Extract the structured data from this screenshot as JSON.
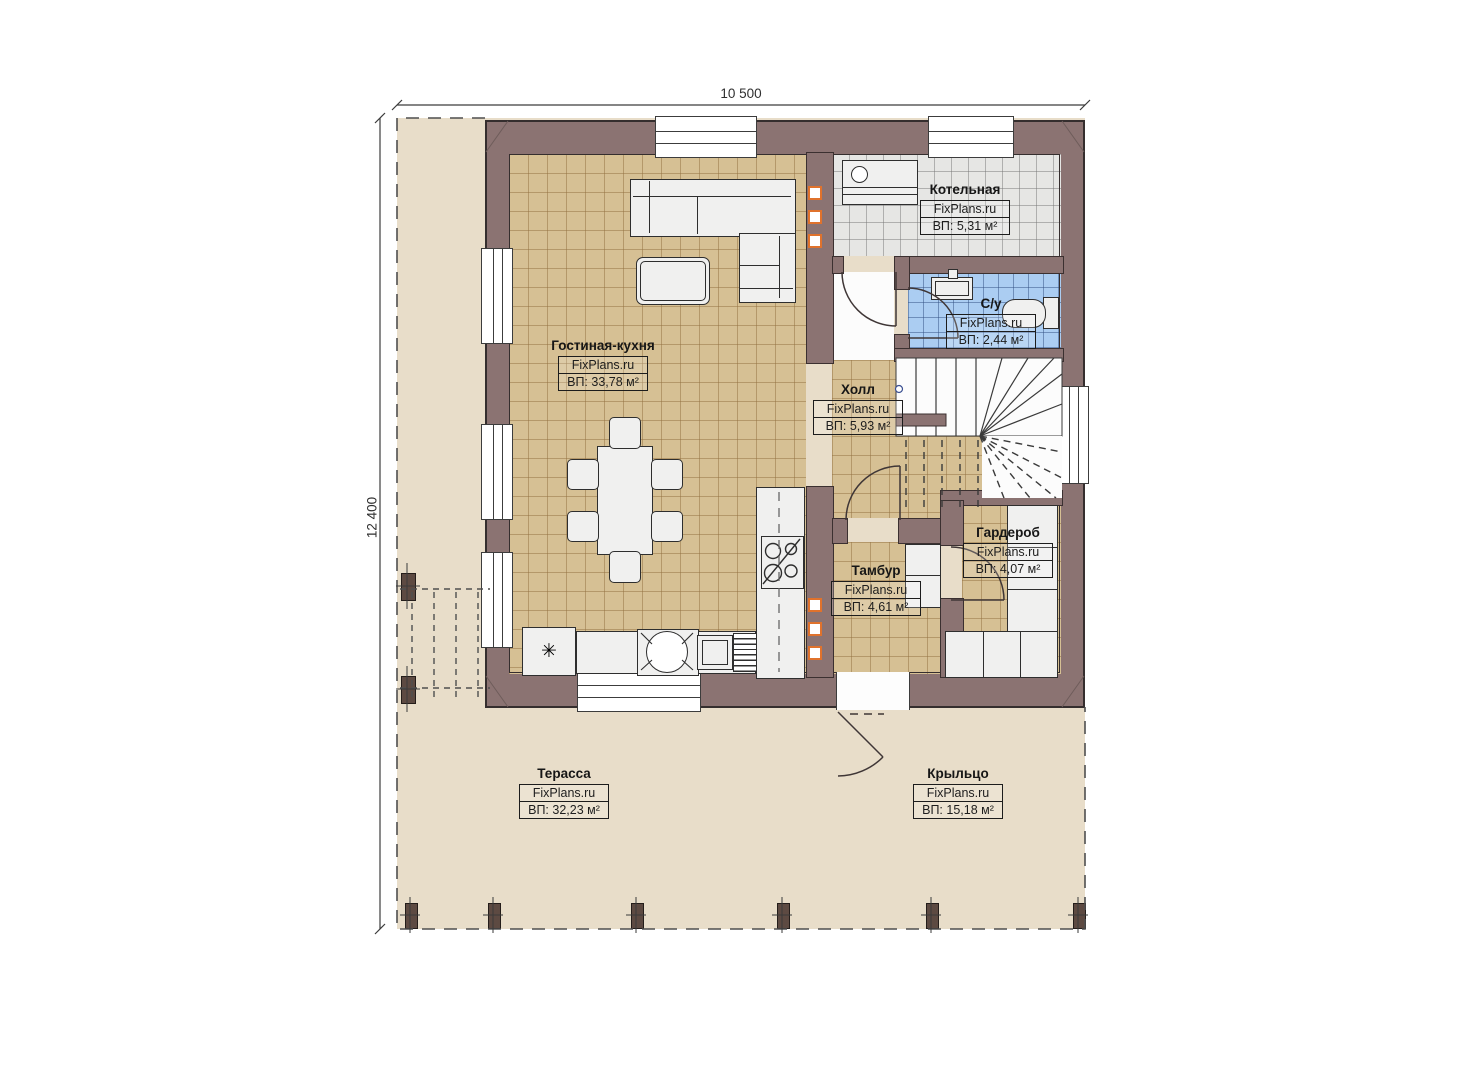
{
  "brand": "FixPlans.ru",
  "dimensions": {
    "width": "10 500",
    "height": "12 400"
  },
  "rooms": [
    {
      "name": "Гостиная-кухня",
      "brand": "FixPlans.ru",
      "area": "ВП: 33,78 м²"
    },
    {
      "name": "Котельная",
      "brand": "FixPlans.ru",
      "area": "ВП: 5,31 м²"
    },
    {
      "name": "С/у",
      "brand": "FixPlans.ru",
      "area": "ВП: 2,44 м²"
    },
    {
      "name": "Холл",
      "brand": "FixPlans.ru",
      "area": "ВП: 5,93 м²"
    },
    {
      "name": "Гардероб",
      "brand": "FixPlans.ru",
      "area": "ВП: 4,07 м²"
    },
    {
      "name": "Тамбур",
      "brand": "FixPlans.ru",
      "area": "ВП: 4,61 м²"
    },
    {
      "name": "Терасса",
      "brand": "FixPlans.ru",
      "area": "ВП: 32,23 м²"
    },
    {
      "name": "Крыльцо",
      "brand": "FixPlans.ru",
      "area": "ВП: 15,18 м²"
    }
  ],
  "icons": {
    "snowflake": "✳"
  },
  "colors": {
    "wall": "#8b7372",
    "floor_tile_tan": "#d6c094",
    "floor_tile_gray": "#e6e6e4",
    "floor_tile_blue": "#abcdf2",
    "terrace": "#e8ddc9",
    "accent_orange": "#e0722c",
    "furniture": "#f0f0ef",
    "line": "#2e2e2e"
  }
}
